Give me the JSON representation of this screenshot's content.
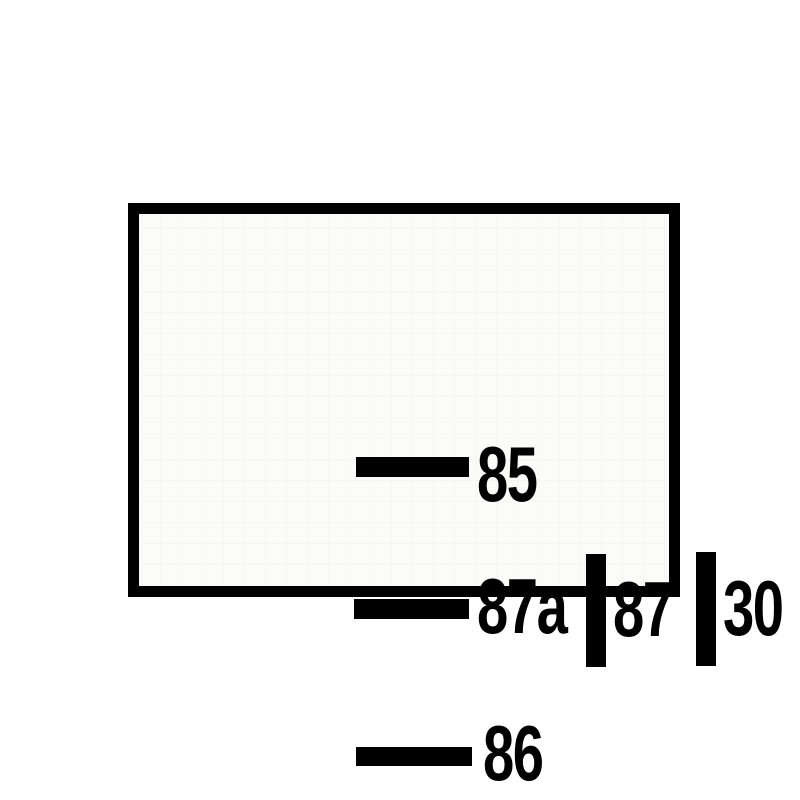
{
  "diagram": {
    "type": "relay-terminal-pin-diagram",
    "colors": {
      "background": "#ffffff",
      "panel_background": "#fbfbfa",
      "ink": "#000000"
    },
    "pins": [
      {
        "label": "85",
        "connector": "horizontal-bar",
        "position": "top-left"
      },
      {
        "label": "87a",
        "connector": "horizontal-bar",
        "position": "middle-left"
      },
      {
        "label": "87",
        "connector": "vertical-bar",
        "position": "middle-center"
      },
      {
        "label": "30",
        "connector": "vertical-bar",
        "position": "middle-right"
      },
      {
        "label": "86",
        "connector": "horizontal-bar",
        "position": "bottom-left"
      }
    ]
  }
}
